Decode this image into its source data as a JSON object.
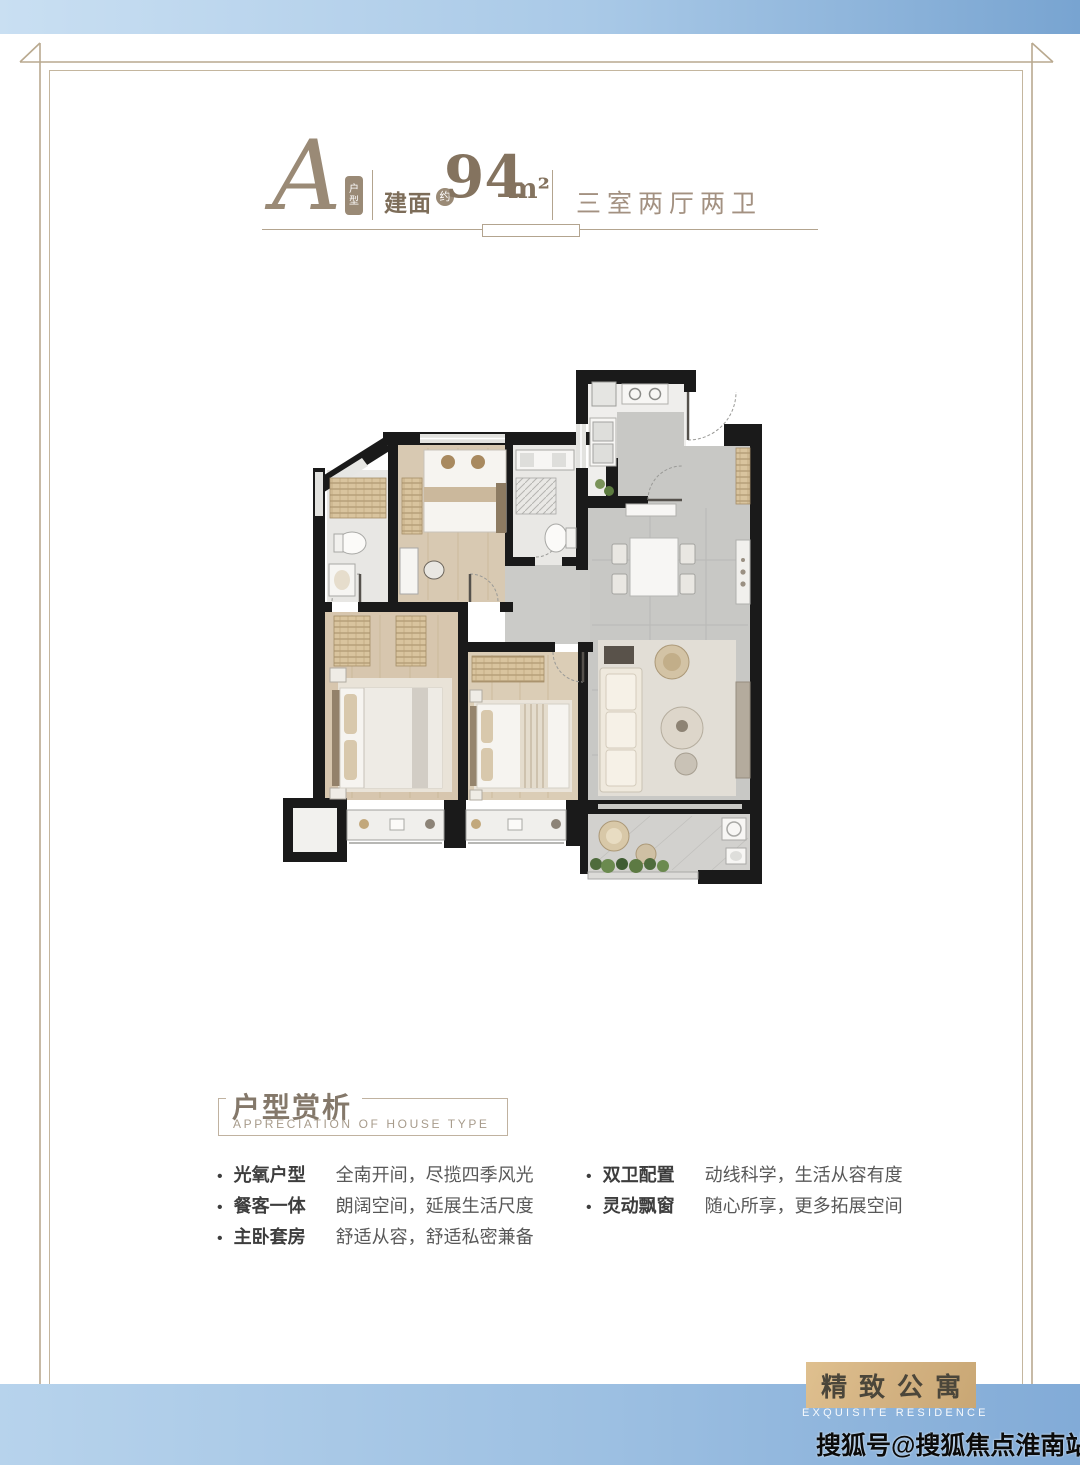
{
  "header": {
    "type_letter": "A",
    "type_badge_char1": "户",
    "type_badge_char2": "型",
    "area_label": "建面",
    "area_approx": "约",
    "area_value": "94",
    "area_unit": "m²",
    "layout_text": "三室两厅两卫"
  },
  "analysis": {
    "title": "户型赏析",
    "subtitle": "APPRECIATION OF HOUSE TYPE",
    "bullet": "•",
    "items_left": [
      {
        "label": "光氧户型",
        "desc": "全南开间，尽揽四季风光"
      },
      {
        "label": "餐客一体",
        "desc": "朗阔空间，延展生活尺度"
      },
      {
        "label": "主卧套房",
        "desc": "舒适从容，舒适私密兼备"
      }
    ],
    "items_right": [
      {
        "label": "双卫配置",
        "desc": "动线科学，生活从容有度"
      },
      {
        "label": "灵动飘窗",
        "desc": "随心所享，更多拓展空间"
      }
    ]
  },
  "badge": {
    "title": "精致公寓",
    "subtitle": "EXQUISITE RESIDENCE"
  },
  "watermark": "搜狐号@搜狐焦点淮南站",
  "colors": {
    "accent_taupe": "#9a8a76",
    "frame_line": "#b9a98f",
    "band_blue_light": "#c9dff2",
    "band_blue_dark": "#78a4d1",
    "badge_tan": "#d4b383",
    "wall_black": "#1a1a1a"
  }
}
